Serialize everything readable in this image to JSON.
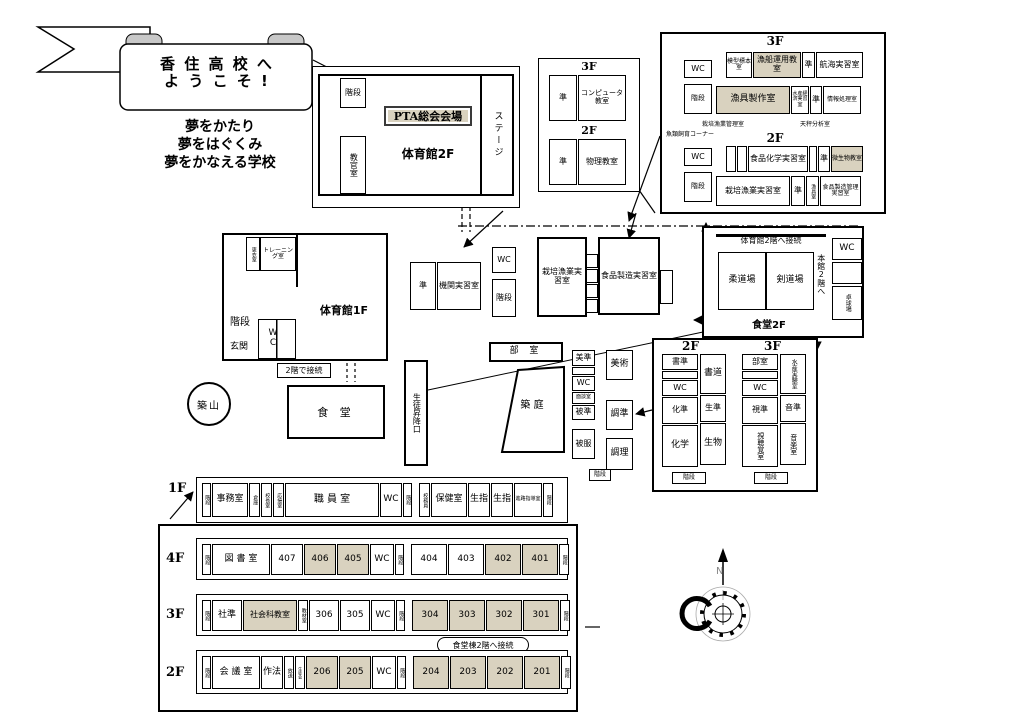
{
  "colors": {
    "shaded": "#d9d2bf",
    "ink": "#000000"
  },
  "banner": {
    "line1": "香 住 高 校 へ",
    "line2": "よ う こ そ !"
  },
  "slogan": {
    "l1": "夢をかたり",
    "l2": "夢をはぐくみ",
    "l3": "夢をかなえる学校"
  },
  "gym2f": {
    "stairs": "階段",
    "pta": "PTA総会会場",
    "name": "体育館2F",
    "stage": "ステージ",
    "instructor": "教官室"
  },
  "annex": {
    "f3": "3F",
    "f2": "2F",
    "rooms3": [
      {
        "t": "準",
        "w": 28,
        "fs": 8
      },
      {
        "t": "コンピュータ教室",
        "w": 48,
        "fs": 7
      }
    ],
    "rooms2": [
      {
        "t": "準",
        "w": 28,
        "fs": 8
      },
      {
        "t": "物理教室",
        "w": 48,
        "fs": 8
      }
    ]
  },
  "fisheries": {
    "f3": "3F",
    "f2": "2F",
    "wc3": "WC",
    "wc2": "WC",
    "stairs3": "階段",
    "stairs2": "階段",
    "note_fish": "魚類飼育コーナー",
    "note_cult": "栽培漁業管理室",
    "note_balance": "天秤分析室",
    "row_a": [
      {
        "t": "模型標本室",
        "w": 26,
        "fs": 6
      },
      {
        "t": "漁船運用教室",
        "w": 48,
        "s": 1,
        "fs": 8
      },
      {
        "t": "準",
        "w": 13,
        "fs": 8
      },
      {
        "t": "航海実習室",
        "w": 47,
        "fs": 8
      }
    ],
    "row_b": [
      {
        "t": "漁具製作室",
        "w": 74,
        "s": 1,
        "fs": 9
      },
      {
        "t": "水産経済実習室",
        "w": 18,
        "fs": 5
      },
      {
        "t": "準",
        "w": 12,
        "fs": 8
      },
      {
        "t": "情報処理室",
        "w": 38,
        "fs": 6
      }
    ],
    "row_c": [
      {
        "t": "",
        "w": 10
      },
      {
        "t": "",
        "w": 10
      },
      {
        "t": "食品化学実習室",
        "w": 60,
        "fs": 8
      },
      {
        "t": "",
        "w": 8
      },
      {
        "t": "準",
        "w": 12,
        "fs": 8
      },
      {
        "t": "微生物教室",
        "w": 32,
        "s": 1,
        "fs": 6
      }
    ],
    "row_d": [
      {
        "t": "栽培漁業実習室",
        "w": 74,
        "fs": 8
      },
      {
        "t": "準",
        "w": 14,
        "fs": 8
      },
      {
        "t": "漁具室",
        "w": 13,
        "v": 1,
        "fs": 5
      },
      {
        "t": "食品製造管理実習室",
        "w": 41,
        "fs": 6
      }
    ]
  },
  "gym1f": {
    "locker": "更衣室",
    "training": "トレーニング室",
    "stairs": "階段",
    "name": "体育館1F",
    "wc": "W C",
    "entrance": "玄関"
  },
  "grounds": {
    "mound": "築山",
    "courtyard": "築 庭",
    "connect2": "2階で接続"
  },
  "cafeteria1f": {
    "name": "食 堂"
  },
  "entrance_hall": "生徒昇降口",
  "machine": {
    "rooms": [
      {
        "t": "準",
        "w": 26,
        "fs": 8
      },
      {
        "t": "機関実習室",
        "w": 44,
        "fs": 8
      }
    ],
    "wc": "WC",
    "stairs": "階段",
    "cultivation": "栽培漁業実習室",
    "food": "食品製造実習室",
    "cells": [
      {
        "t": "",
        "h": 14
      },
      {
        "t": "",
        "h": 14
      },
      {
        "t": "",
        "h": 14
      },
      {
        "t": "",
        "h": 14
      }
    ]
  },
  "cafeteria2f": {
    "connect": "体育館2階へ接続",
    "judo": "柔道場",
    "kendo": "剣道場",
    "honkan": "本館2階へ",
    "wc": "WC",
    "pingpong": "卓球場",
    "name": "食堂2F"
  },
  "clubrooms": "部 室",
  "art": {
    "left": [
      {
        "t": "美準",
        "h": 16,
        "fs": 8
      },
      {
        "t": "",
        "h": 8
      },
      {
        "t": "WC",
        "h": 15,
        "fs": 8
      },
      {
        "t": "面談室",
        "h": 12,
        "fs": 5
      },
      {
        "t": "被準",
        "h": 15,
        "fs": 8
      },
      {
        "t": "",
        "h": 7,
        "gap": 1
      },
      {
        "t": "被服",
        "h": 30,
        "fs": 8
      }
    ],
    "right": [
      {
        "t": "美術",
        "h": 30,
        "fs": 9
      },
      {
        "t": "",
        "h": 18,
        "gap": 1
      },
      {
        "t": "調準",
        "h": 30,
        "fs": 9
      },
      {
        "t": "",
        "h": 6,
        "gap": 1
      },
      {
        "t": "調理",
        "h": 32,
        "fs": 9
      }
    ],
    "stairs": "階段"
  },
  "sci": {
    "f2": "2F",
    "f3": "3F",
    "stairs2": "階段",
    "stairs3": "階段",
    "f2l": [
      {
        "t": "書準",
        "h": 16,
        "fs": 8
      },
      {
        "t": "",
        "h": 8
      },
      {
        "t": "WC",
        "h": 16,
        "fs": 8
      },
      {
        "t": "化準",
        "h": 27,
        "fs": 8
      },
      {
        "t": "化学",
        "h": 42,
        "fs": 9
      }
    ],
    "f2r": [
      {
        "t": "書道",
        "h": 40,
        "fs": 9
      },
      {
        "t": "生準",
        "h": 27,
        "fs": 8
      },
      {
        "t": "生物",
        "h": 42,
        "fs": 9
      }
    ],
    "f3l": [
      {
        "t": "部室",
        "h": 16,
        "fs": 8
      },
      {
        "t": "",
        "h": 8
      },
      {
        "t": "WC",
        "h": 16,
        "fs": 8
      },
      {
        "t": "視準",
        "h": 27,
        "fs": 8
      },
      {
        "t": "視聴覚室",
        "h": 42,
        "v": 1,
        "fs": 7
      }
    ],
    "f3r": [
      {
        "t": "水産実験室",
        "h": 40,
        "v": 1,
        "fs": 6
      },
      {
        "t": "音準",
        "h": 27,
        "fs": 8
      },
      {
        "t": "音楽室",
        "h": 42,
        "v": 1,
        "fs": 7
      }
    ]
  },
  "floors": {
    "f1_label": "1F",
    "f4_label": "4F",
    "f3_label": "3F",
    "f2_label": "2F",
    "f1": [
      {
        "t": "階段",
        "w": 9,
        "v": 1,
        "fs": 5
      },
      {
        "t": "事務室",
        "w": 36,
        "fs": 9
      },
      {
        "t": "倉庫",
        "w": 11,
        "v": 1,
        "fs": 5
      },
      {
        "t": "校長室",
        "w": 11,
        "v": 1,
        "fs": 5
      },
      {
        "t": "応接室",
        "w": 11,
        "v": 1,
        "fs": 5
      },
      {
        "t": "職 員 室",
        "w": 94,
        "fs": 10
      },
      {
        "t": "WC",
        "w": 22,
        "fs": 9
      },
      {
        "t": "階段",
        "w": 9,
        "v": 1,
        "fs": 5
      },
      {
        "t": "",
        "w": 5,
        "gap": 1
      },
      {
        "t": "校務員",
        "w": 11,
        "v": 1,
        "fs": 5
      },
      {
        "t": "保健室",
        "w": 36,
        "fs": 9
      },
      {
        "t": "生指",
        "w": 22,
        "fs": 9
      },
      {
        "t": "生指",
        "w": 22,
        "fs": 9
      },
      {
        "t": "進路指導室",
        "w": 28,
        "fs": 5
      },
      {
        "t": "階段",
        "w": 10,
        "v": 1,
        "fs": 5
      }
    ],
    "f4": [
      {
        "t": "階段",
        "w": 9,
        "v": 1,
        "fs": 5
      },
      {
        "t": "図 書 室",
        "w": 58,
        "fs": 9
      },
      {
        "t": "407",
        "w": 32
      },
      {
        "t": "406",
        "w": 32,
        "s": 1
      },
      {
        "t": "405",
        "w": 32,
        "s": 1
      },
      {
        "t": "WC",
        "w": 24
      },
      {
        "t": "階段",
        "w": 9,
        "v": 1,
        "fs": 5
      },
      {
        "t": "",
        "w": 5,
        "gap": 1
      },
      {
        "t": "404",
        "w": 36
      },
      {
        "t": "403",
        "w": 36
      },
      {
        "t": "402",
        "w": 36,
        "s": 1
      },
      {
        "t": "401",
        "w": 36,
        "s": 1
      },
      {
        "t": "階段",
        "w": 10,
        "v": 1,
        "fs": 5
      }
    ],
    "f3": [
      {
        "t": "階段",
        "w": 9,
        "v": 1,
        "fs": 5
      },
      {
        "t": "社準",
        "w": 30
      },
      {
        "t": "社会科教室",
        "w": 54,
        "s": 1,
        "fs": 8
      },
      {
        "t": "教材室",
        "w": 10,
        "v": 1,
        "fs": 5
      },
      {
        "t": "306",
        "w": 30
      },
      {
        "t": "305",
        "w": 30
      },
      {
        "t": "WC",
        "w": 24
      },
      {
        "t": "階段",
        "w": 9,
        "v": 1,
        "fs": 5
      },
      {
        "t": "",
        "w": 5,
        "gap": 1
      },
      {
        "t": "304",
        "w": 36,
        "s": 1
      },
      {
        "t": "303",
        "w": 36,
        "s": 1
      },
      {
        "t": "302",
        "w": 36,
        "s": 1
      },
      {
        "t": "301",
        "w": 36,
        "s": 1
      },
      {
        "t": "階段",
        "w": 10,
        "v": 1,
        "fs": 5
      }
    ],
    "f2": [
      {
        "t": "階段",
        "w": 9,
        "v": 1,
        "fs": 5
      },
      {
        "t": "会 議 室",
        "w": 48,
        "fs": 9
      },
      {
        "t": "作法",
        "w": 22
      },
      {
        "t": "放送",
        "w": 10,
        "v": 1,
        "fs": 5
      },
      {
        "t": "生徒会",
        "w": 10,
        "v": 1,
        "fs": 4
      },
      {
        "t": "206",
        "w": 32,
        "s": 1
      },
      {
        "t": "205",
        "w": 32,
        "s": 1
      },
      {
        "t": "WC",
        "w": 24
      },
      {
        "t": "階段",
        "w": 9,
        "v": 1,
        "fs": 5
      },
      {
        "t": "",
        "w": 5,
        "gap": 1
      },
      {
        "t": "204",
        "w": 36,
        "s": 1
      },
      {
        "t": "203",
        "w": 36,
        "s": 1
      },
      {
        "t": "202",
        "w": 36,
        "s": 1
      },
      {
        "t": "201",
        "w": 36,
        "s": 1
      },
      {
        "t": "階段",
        "w": 10,
        "v": 1,
        "fs": 5
      }
    ]
  },
  "annotations": {
    "dining_connect": "食堂棟2階へ接続",
    "compass_n": "N"
  }
}
